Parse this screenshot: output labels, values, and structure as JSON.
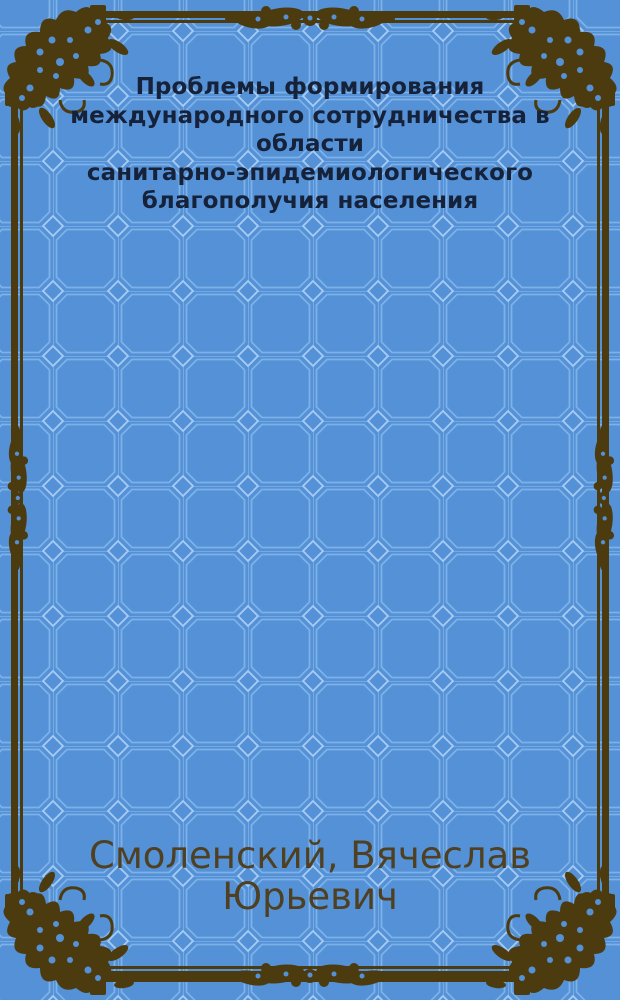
{
  "cover": {
    "title": "Проблемы формирования международного сотрудничества в области санитарно-эпидемиологического благополучия населения",
    "title_lines": [
      "Проблемы формирования",
      "международного сотрудничества в",
      "области",
      "санитарно-эпидемиологического",
      "благополучия населения"
    ],
    "author": "Смоленский, Вячеслав Юрьевич",
    "author_lines": [
      "Смоленский, Вячеслав",
      "Юрьевич"
    ],
    "colors": {
      "background": "#5591d6",
      "pattern_line": "#7db1e8",
      "pattern_accent": "#a6ccf4",
      "frame": "#4d3b10",
      "title_text": "#16223a",
      "author_text": "#4f4022"
    }
  }
}
